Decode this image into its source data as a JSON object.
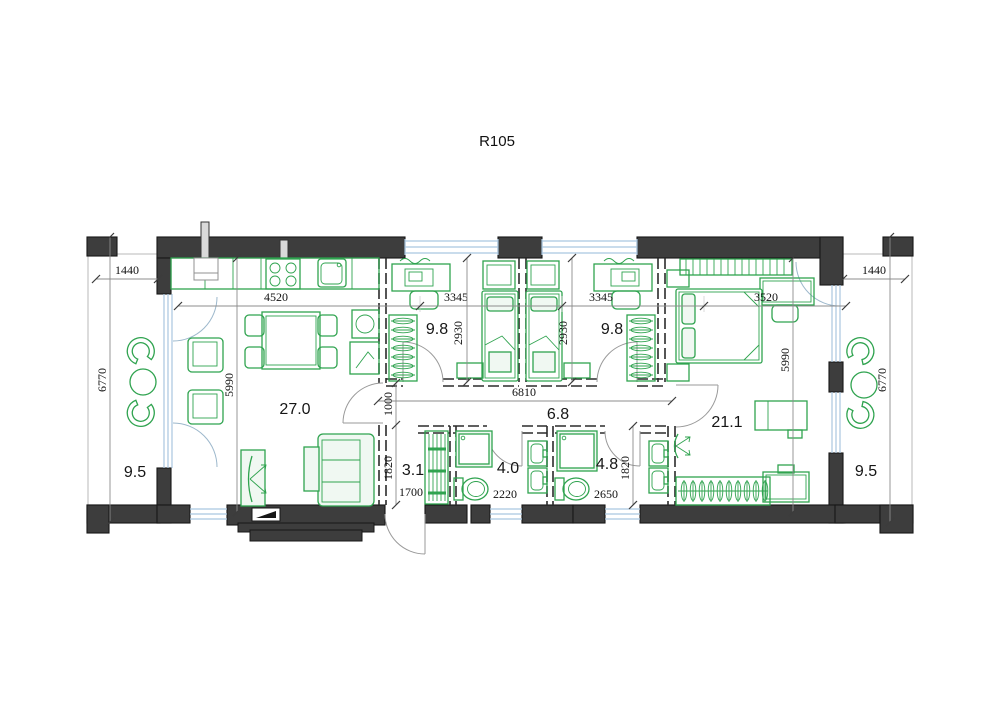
{
  "title": "R105",
  "rooms": [
    {
      "name": "terrace-left",
      "area": "9.5"
    },
    {
      "name": "living-room-kitchen",
      "area": "27.0"
    },
    {
      "name": "bedroom-1",
      "area": "9.8"
    },
    {
      "name": "bedroom-2",
      "area": "9.8"
    },
    {
      "name": "hallway",
      "area": "6.8"
    },
    {
      "name": "master-bedroom",
      "area": "21.1"
    },
    {
      "name": "wardrobe-corridor",
      "area": "3.1"
    },
    {
      "name": "bathroom-1",
      "area": "4.0"
    },
    {
      "name": "bathroom-2",
      "area": "4.8"
    },
    {
      "name": "terrace-right",
      "area": "9.5"
    }
  ],
  "dimensions_mm": {
    "terrace_left_width": "1440",
    "kitchen_living_width": "4520",
    "bedroom1_width": "3345",
    "bedroom2_width": "3345",
    "master_bedroom_width": "3520",
    "terrace_right_width": "1440",
    "terrace_left_depth": "6770",
    "living_glazing_depth": "5990",
    "bedroom1_depth": "2930",
    "bedroom2_depth": "2930",
    "master_glazing_depth": "5990",
    "terrace_right_depth": "6770",
    "hallway_length": "6810",
    "hallway_width": "1000",
    "corridor_depth": "1820",
    "rack_length": "1700",
    "bathroom1_width": "2220",
    "bathroom2_width": "2650",
    "bathroom2_depth": "1820"
  },
  "colors": {
    "wall_fill": "#3d3d3d",
    "furniture_green": "#2fa34f",
    "glazing_blue": "#a9c6e0",
    "dimension_text": "#111111",
    "background": "#ffffff"
  }
}
